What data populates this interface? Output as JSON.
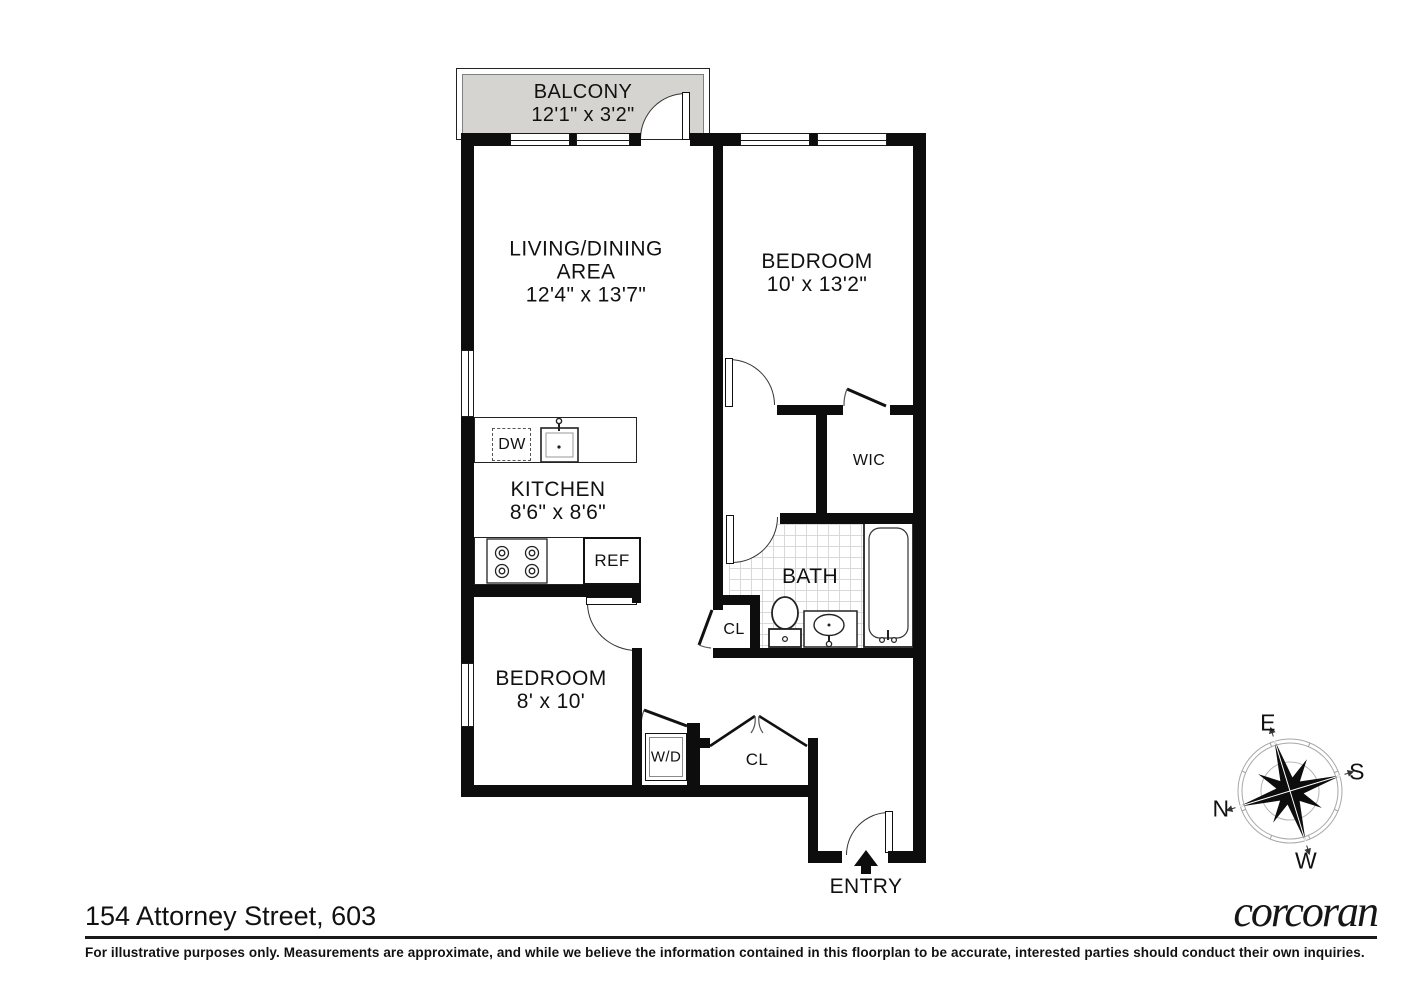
{
  "title": "154 Attorney Street, 603",
  "brand": "corcoran",
  "disclaimer": "For illustrative purposes only.  Measurements are approximate, and while we believe the information contained in this floorplan to be accurate, interested parties should conduct their own inquiries.",
  "rooms": {
    "balcony": {
      "name": "BALCONY",
      "dims": "12'1\" x 3'2\""
    },
    "living": {
      "line1": "LIVING/DINING",
      "line2": "AREA",
      "dims": "12'4\" x 13'7\""
    },
    "bedroom1": {
      "name": "BEDROOM",
      "dims": "10' x 13'2\""
    },
    "wic": {
      "name": "WIC"
    },
    "kitchen": {
      "name": "KITCHEN",
      "dims": "8'6\" x 8'6\""
    },
    "bath": {
      "name": "BATH"
    },
    "closet_bath": {
      "name": "CL"
    },
    "bedroom2": {
      "name": "BEDROOM",
      "dims": "8' x 10'"
    },
    "wd": {
      "name": "W/D"
    },
    "closet_hall": {
      "name": "CL"
    },
    "entry": {
      "name": "ENTRY"
    },
    "dw": {
      "name": "DW"
    },
    "ref": {
      "name": "REF"
    }
  },
  "compass": {
    "e": "E",
    "s": "S",
    "w": "W",
    "n": "N"
  },
  "colors": {
    "wall": "#0d0d0d",
    "balcony_fill": "#d6d4d1",
    "tile_line": "#d9d9d9"
  }
}
